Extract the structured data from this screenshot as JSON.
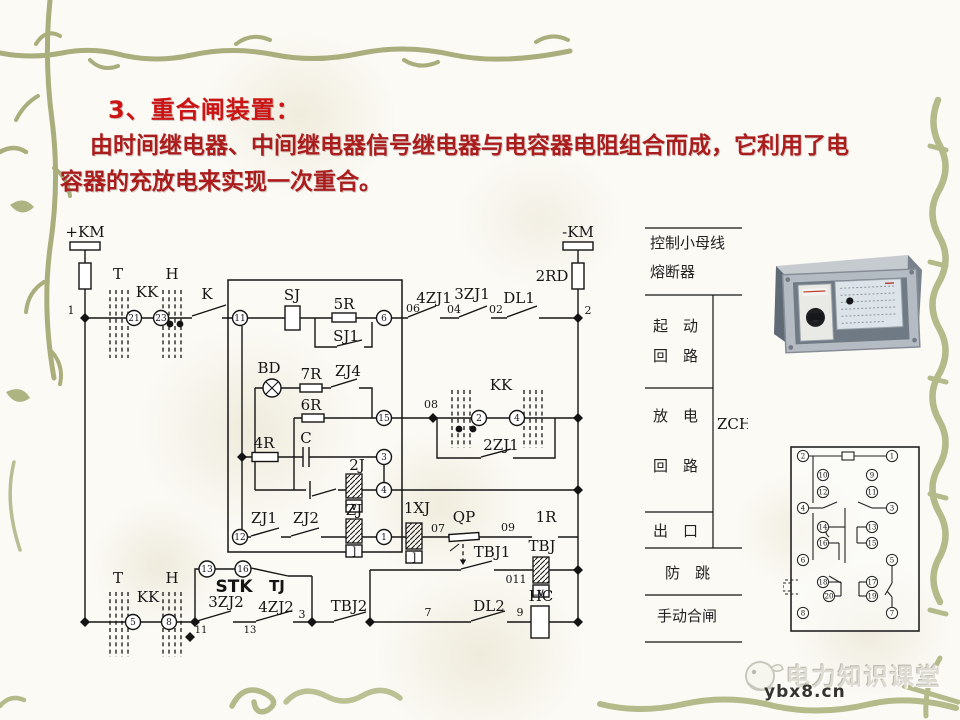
{
  "slide": {
    "title": "3、重合闸装置：",
    "body_line1": "由时间继电器、中间继电器信号继电器与电容器电阻组合而成，它利用了电",
    "body_line2": "容器的充放电来实现一次重合。"
  },
  "colors": {
    "title_red": "#cc1414",
    "body_red": "#ab1d1d",
    "vine_olive": "#a9ae7c",
    "vine_light": "#b5ba8a",
    "line_black": "#141414"
  },
  "circuit": {
    "labels": {
      "pkm": "+KM",
      "mkm": "-KM",
      "rd2": "2RD",
      "n1": "1",
      "n2": "2",
      "t": "T",
      "h": "H",
      "kk": "KK",
      "k": "K",
      "c21": "21",
      "c23": "23",
      "c11": "11",
      "sj": "SJ",
      "r5": "5R",
      "sj1": "SJ1",
      "c6": "6",
      "n06": "06",
      "zj41": "4ZJ1",
      "n04": "04",
      "zj31": "3ZJ1",
      "n02": "02",
      "dl1": "DL1",
      "bd": "BD",
      "r7": "7R",
      "zj4": "ZJ4",
      "r6": "6R",
      "c15": "15",
      "r4": "4R",
      "cap": "C",
      "c3": "3",
      "j2": "2J",
      "c4": "4",
      "n08": "08",
      "c2": "2",
      "zj21": "2ZJ1",
      "c12": "12",
      "zj1": "ZJ1",
      "zj2": "ZJ2",
      "zj": "ZJ",
      "c1": "1",
      "xj1": "1XJ",
      "n07": "07",
      "qp": "QP",
      "n09": "09",
      "r1": "1R",
      "tbj1": "TBJ1",
      "tbj": "TBJ",
      "n011": "011",
      "c13": "13",
      "c16": "16",
      "stk": "STK",
      "tj": "TJ",
      "c5": "5",
      "c8": "8",
      "n11": "11",
      "zj32": "3ZJ2",
      "n13": "13",
      "zj42": "4ZJ2",
      "n3": "3",
      "tbj2": "TBJ2",
      "n7": "7",
      "dl2": "DL2",
      "n9": "9",
      "hc": "HC",
      "vmark": "∨",
      "bmark": "]"
    }
  },
  "panel": {
    "rows": [
      "控制小母线",
      "熔断器",
      "起　动",
      "回　路",
      "放　电",
      "回　路",
      "出　口",
      "防　跳",
      "手动合闸"
    ],
    "zch": "ZCH"
  },
  "terminal_diagram": {
    "outer_left": [
      "2",
      "4",
      "6",
      "8"
    ],
    "inner_left": [
      "10",
      "12",
      "14",
      "16",
      "18",
      "20"
    ],
    "inner_right": [
      "9",
      "11",
      "13",
      "15",
      "17",
      "19"
    ],
    "outer_right": [
      "1",
      "3",
      "5",
      "7"
    ]
  },
  "watermark": {
    "brand": "电力知识课堂",
    "site": "ybx8.cn"
  }
}
